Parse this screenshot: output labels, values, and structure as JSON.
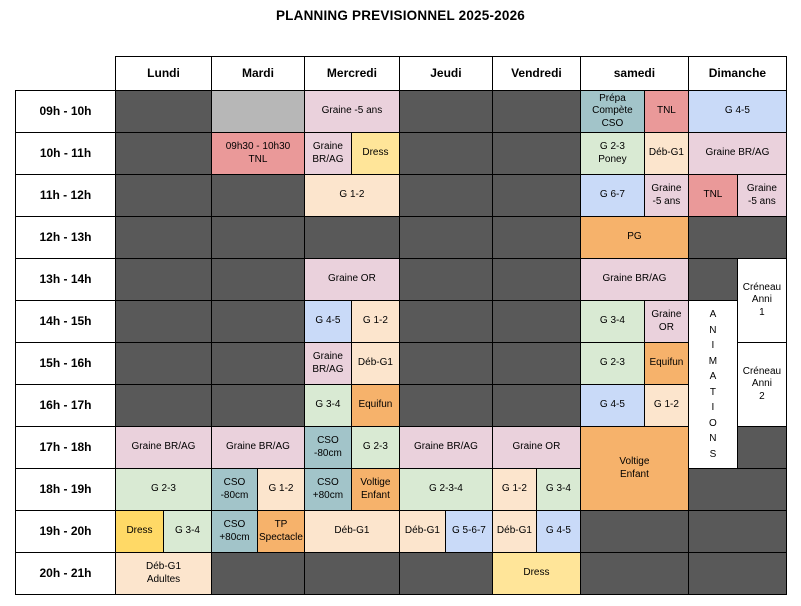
{
  "title": "PLANNING PREVISIONNEL 2025-2026",
  "colors": {
    "dark_gray": "#595959",
    "light_gray": "#b7b7b7",
    "pink": "#ead1dc",
    "peach": "#fce5cd",
    "green": "#d9ead3",
    "blue": "#c9daf8",
    "teal": "#a2c4c9",
    "red": "#ea9999",
    "orange": "#f6b26b",
    "yellow": "#ffd966",
    "light_yellow": "#ffe599",
    "white": "#ffffff"
  },
  "days": [
    "Lundi",
    "Mardi",
    "Mercredi",
    "Jeudi",
    "Vendredi",
    "samedi",
    "Dimanche"
  ],
  "rows": [
    {
      "time": "09h - 10h",
      "cells": [
        {
          "day": "Lundi",
          "span": 2,
          "color": "dark_gray",
          "text": ""
        },
        {
          "day": "Mardi",
          "span": 2,
          "color": "light_gray",
          "text": ""
        },
        {
          "day": "Mercredi",
          "span": 2,
          "color": "pink",
          "text": "Graine -5 ans"
        },
        {
          "day": "Jeudi",
          "span": 2,
          "color": "dark_gray",
          "text": ""
        },
        {
          "day": "Vendredi",
          "span": 2,
          "color": "dark_gray",
          "text": ""
        },
        {
          "day": "samedi",
          "span": 1,
          "color": "teal",
          "text": "Prépa\nCompète\nCSO"
        },
        {
          "day": "samedi",
          "span": 1,
          "color": "red",
          "text": "TNL"
        },
        {
          "day": "Dimanche",
          "span": 2,
          "color": "blue",
          "text": "G 4-5"
        }
      ]
    },
    {
      "time": "10h - 11h",
      "cells": [
        {
          "day": "Lundi",
          "span": 2,
          "color": "dark_gray",
          "text": ""
        },
        {
          "day": "Mardi",
          "span": 2,
          "color": "red",
          "text": "09h30 - 10h30\nTNL"
        },
        {
          "day": "Mercredi",
          "span": 1,
          "color": "pink",
          "text": "Graine\nBR/AG"
        },
        {
          "day": "Mercredi",
          "span": 1,
          "color": "light_yellow",
          "text": "Dress"
        },
        {
          "day": "Jeudi",
          "span": 2,
          "color": "dark_gray",
          "text": ""
        },
        {
          "day": "Vendredi",
          "span": 2,
          "color": "dark_gray",
          "text": ""
        },
        {
          "day": "samedi",
          "span": 1,
          "color": "green",
          "text": "G 2-3\nPoney"
        },
        {
          "day": "samedi",
          "span": 1,
          "color": "peach",
          "text": "Déb-G1"
        },
        {
          "day": "Dimanche",
          "span": 2,
          "color": "pink",
          "text": "Graine BR/AG"
        }
      ]
    },
    {
      "time": "11h - 12h",
      "cells": [
        {
          "day": "Lundi",
          "span": 2,
          "color": "dark_gray",
          "text": ""
        },
        {
          "day": "Mardi",
          "span": 2,
          "color": "dark_gray",
          "text": ""
        },
        {
          "day": "Mercredi",
          "span": 2,
          "color": "peach",
          "text": "G 1-2"
        },
        {
          "day": "Jeudi",
          "span": 2,
          "color": "dark_gray",
          "text": ""
        },
        {
          "day": "Vendredi",
          "span": 2,
          "color": "dark_gray",
          "text": ""
        },
        {
          "day": "samedi",
          "span": 1,
          "color": "blue",
          "text": "G 6-7"
        },
        {
          "day": "samedi",
          "span": 1,
          "color": "pink",
          "text": "Graine\n-5 ans"
        },
        {
          "day": "Dimanche",
          "span": 1,
          "color": "red",
          "text": "TNL"
        },
        {
          "day": "Dimanche",
          "span": 1,
          "color": "pink",
          "text": "Graine\n-5 ans"
        }
      ]
    },
    {
      "time": "12h - 13h",
      "cells": [
        {
          "day": "Lundi",
          "span": 2,
          "color": "dark_gray",
          "text": ""
        },
        {
          "day": "Mardi",
          "span": 2,
          "color": "dark_gray",
          "text": ""
        },
        {
          "day": "Mercredi",
          "span": 2,
          "color": "dark_gray",
          "text": ""
        },
        {
          "day": "Jeudi",
          "span": 2,
          "color": "dark_gray",
          "text": ""
        },
        {
          "day": "Vendredi",
          "span": 2,
          "color": "dark_gray",
          "text": ""
        },
        {
          "day": "samedi",
          "span": 2,
          "color": "orange",
          "text": "PG"
        },
        {
          "day": "Dimanche",
          "span": 2,
          "color": "dark_gray",
          "text": ""
        }
      ]
    },
    {
      "time": "13h - 14h",
      "cells": [
        {
          "day": "Lundi",
          "span": 2,
          "color": "dark_gray",
          "text": ""
        },
        {
          "day": "Mardi",
          "span": 2,
          "color": "dark_gray",
          "text": ""
        },
        {
          "day": "Mercredi",
          "span": 2,
          "color": "pink",
          "text": "Graine OR"
        },
        {
          "day": "Jeudi",
          "span": 2,
          "color": "dark_gray",
          "text": ""
        },
        {
          "day": "Vendredi",
          "span": 2,
          "color": "dark_gray",
          "text": ""
        },
        {
          "day": "samedi",
          "span": 2,
          "color": "pink",
          "text": "Graine BR/AG"
        },
        {
          "day": "Dimanche",
          "span": 1,
          "color": "dark_gray",
          "text": ""
        },
        {
          "day": "Dimanche",
          "span": 1,
          "rowspan": 2,
          "color": "white",
          "text": "Créneau\nAnni\n1",
          "name": "creneau-anni-1-cell"
        }
      ]
    },
    {
      "time": "14h - 15h",
      "cells": [
        {
          "day": "Lundi",
          "span": 2,
          "color": "dark_gray",
          "text": ""
        },
        {
          "day": "Mardi",
          "span": 2,
          "color": "dark_gray",
          "text": ""
        },
        {
          "day": "Mercredi",
          "span": 1,
          "color": "blue",
          "text": "G 4-5"
        },
        {
          "day": "Mercredi",
          "span": 1,
          "color": "peach",
          "text": "G 1-2"
        },
        {
          "day": "Jeudi",
          "span": 2,
          "color": "dark_gray",
          "text": ""
        },
        {
          "day": "Vendredi",
          "span": 2,
          "color": "dark_gray",
          "text": ""
        },
        {
          "day": "samedi",
          "span": 1,
          "color": "green",
          "text": "G 3-4"
        },
        {
          "day": "samedi",
          "span": 1,
          "color": "pink",
          "text": "Graine\nOR"
        },
        {
          "day": "Dimanche",
          "span": 1,
          "rowspan": 4,
          "color": "white",
          "text": "ANIMATIONS",
          "vertical": true,
          "name": "animations-cell"
        }
      ]
    },
    {
      "time": "15h - 16h",
      "cells": [
        {
          "day": "Lundi",
          "span": 2,
          "color": "dark_gray",
          "text": ""
        },
        {
          "day": "Mardi",
          "span": 2,
          "color": "dark_gray",
          "text": ""
        },
        {
          "day": "Mercredi",
          "span": 1,
          "color": "pink",
          "text": "Graine\nBR/AG"
        },
        {
          "day": "Mercredi",
          "span": 1,
          "color": "peach",
          "text": "Déb-G1"
        },
        {
          "day": "Jeudi",
          "span": 2,
          "color": "dark_gray",
          "text": ""
        },
        {
          "day": "Vendredi",
          "span": 2,
          "color": "dark_gray",
          "text": ""
        },
        {
          "day": "samedi",
          "span": 1,
          "color": "green",
          "text": "G 2-3"
        },
        {
          "day": "samedi",
          "span": 1,
          "color": "orange",
          "text": "Equifun"
        },
        {
          "day": "Dimanche",
          "span": 1,
          "rowspan": 2,
          "color": "white",
          "text": "Créneau\nAnni\n2",
          "name": "creneau-anni-2-cell"
        }
      ]
    },
    {
      "time": "16h - 17h",
      "cells": [
        {
          "day": "Lundi",
          "span": 2,
          "color": "dark_gray",
          "text": ""
        },
        {
          "day": "Mardi",
          "span": 2,
          "color": "dark_gray",
          "text": ""
        },
        {
          "day": "Mercredi",
          "span": 1,
          "color": "green",
          "text": "G 3-4"
        },
        {
          "day": "Mercredi",
          "span": 1,
          "color": "orange",
          "text": "Equifun"
        },
        {
          "day": "Jeudi",
          "span": 2,
          "color": "dark_gray",
          "text": ""
        },
        {
          "day": "Vendredi",
          "span": 2,
          "color": "dark_gray",
          "text": ""
        },
        {
          "day": "samedi",
          "span": 1,
          "color": "blue",
          "text": "G 4-5"
        },
        {
          "day": "samedi",
          "span": 1,
          "color": "peach",
          "text": "G 1-2"
        }
      ]
    },
    {
      "time": "17h - 18h",
      "cells": [
        {
          "day": "Lundi",
          "span": 2,
          "color": "pink",
          "text": "Graine BR/AG"
        },
        {
          "day": "Mardi",
          "span": 2,
          "color": "pink",
          "text": "Graine BR/AG"
        },
        {
          "day": "Mercredi",
          "span": 1,
          "color": "teal",
          "text": "CSO\n-80cm"
        },
        {
          "day": "Mercredi",
          "span": 1,
          "color": "green",
          "text": "G 2-3"
        },
        {
          "day": "Jeudi",
          "span": 2,
          "color": "pink",
          "text": "Graine BR/AG"
        },
        {
          "day": "Vendredi",
          "span": 2,
          "color": "pink",
          "text": "Graine OR"
        },
        {
          "day": "samedi",
          "span": 2,
          "rowspan": 2,
          "color": "orange",
          "text": "Voltige\nEnfant"
        },
        {
          "day": "Dimanche",
          "span": 1,
          "color": "dark_gray",
          "text": ""
        }
      ]
    },
    {
      "time": "18h - 19h",
      "cells": [
        {
          "day": "Lundi",
          "span": 2,
          "color": "green",
          "text": "G 2-3"
        },
        {
          "day": "Mardi",
          "span": 1,
          "color": "teal",
          "text": "CSO\n-80cm"
        },
        {
          "day": "Mardi",
          "span": 1,
          "color": "peach",
          "text": "G 1-2"
        },
        {
          "day": "Mercredi",
          "span": 1,
          "color": "teal",
          "text": "CSO\n+80cm"
        },
        {
          "day": "Mercredi",
          "span": 1,
          "color": "orange",
          "text": "Voltige\nEnfant"
        },
        {
          "day": "Jeudi",
          "span": 2,
          "color": "green",
          "text": "G 2-3-4"
        },
        {
          "day": "Vendredi",
          "span": 1,
          "color": "peach",
          "text": "G 1-2"
        },
        {
          "day": "Vendredi",
          "span": 1,
          "color": "green",
          "text": "G 3-4"
        },
        {
          "day": "Dimanche",
          "span": 2,
          "color": "dark_gray",
          "text": ""
        }
      ]
    },
    {
      "time": "19h - 20h",
      "cells": [
        {
          "day": "Lundi",
          "span": 1,
          "color": "yellow",
          "text": "Dress"
        },
        {
          "day": "Lundi",
          "span": 1,
          "color": "green",
          "text": "G 3-4"
        },
        {
          "day": "Mardi",
          "span": 1,
          "color": "teal",
          "text": "CSO\n+80cm"
        },
        {
          "day": "Mardi",
          "span": 1,
          "color": "orange",
          "text": "TP\nSpectacle"
        },
        {
          "day": "Mercredi",
          "span": 2,
          "color": "peach",
          "text": "Déb-G1"
        },
        {
          "day": "Jeudi",
          "span": 1,
          "color": "peach",
          "text": "Déb-G1"
        },
        {
          "day": "Jeudi",
          "span": 1,
          "color": "blue",
          "text": "G 5-6-7"
        },
        {
          "day": "Vendredi",
          "span": 1,
          "color": "peach",
          "text": "Déb-G1"
        },
        {
          "day": "Vendredi",
          "span": 1,
          "color": "blue",
          "text": "G 4-5"
        },
        {
          "day": "samedi",
          "span": 2,
          "color": "dark_gray",
          "text": ""
        },
        {
          "day": "Dimanche",
          "span": 2,
          "color": "dark_gray",
          "text": ""
        }
      ]
    },
    {
      "time": "20h - 21h",
      "cells": [
        {
          "day": "Lundi",
          "span": 2,
          "color": "peach",
          "text": "Déb-G1\nAdultes"
        },
        {
          "day": "Mardi",
          "span": 2,
          "color": "dark_gray",
          "text": ""
        },
        {
          "day": "Mercredi",
          "span": 2,
          "color": "dark_gray",
          "text": ""
        },
        {
          "day": "Jeudi",
          "span": 2,
          "color": "dark_gray",
          "text": ""
        },
        {
          "day": "Vendredi",
          "span": 2,
          "color": "light_yellow",
          "text": "Dress"
        },
        {
          "day": "samedi",
          "span": 2,
          "color": "dark_gray",
          "text": ""
        },
        {
          "day": "Dimanche",
          "span": 2,
          "color": "dark_gray",
          "text": ""
        }
      ]
    }
  ]
}
